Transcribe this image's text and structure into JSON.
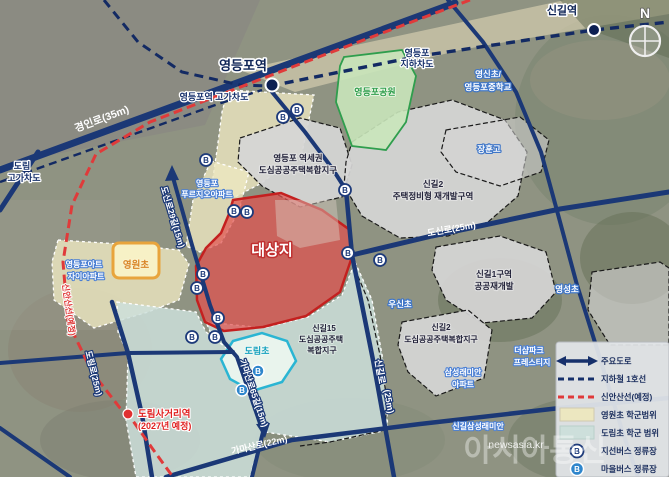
{
  "compass": "N",
  "target_label": "대상지",
  "park_label": "영등포공원",
  "bus_letter": "B",
  "stations": {
    "yeongdeungpo": "영등포역",
    "singil": "신길역",
    "dorim_name": "도림사거리역",
    "dorim_note": "(2027년 예정)"
  },
  "roads": {
    "gyeongin": "경인로(35m)",
    "ydp_overpass": "영등포역 고가차도",
    "ydp_underpass_1": "영등포",
    "ydp_underpass_2": "지하차도",
    "dorim_overpass_1": "도림",
    "dorim_overpass_2": "고가차도",
    "dosinro29": "도신로29길(15m)",
    "dosinro": "도신로(25m)",
    "singilro_1": "신길로",
    "singilro_2": "(25m)",
    "gamasan65": "가마산로65길(15m)",
    "gamasan": "가마산로(22m)",
    "dorimro": "도림로(25m)",
    "sinansan": "신안산선(예정)"
  },
  "zones": {
    "ydp_station": [
      "영등포 역세권",
      "도심공공주택복합지구"
    ],
    "singil2_north": [
      "신길2",
      "주택정비형 재개발구역"
    ],
    "singil1": [
      "신길1구역",
      "공공재개발"
    ],
    "singil15": [
      "신길15",
      "도심공공주택",
      "복합지구"
    ],
    "singil2_south": [
      "신길2",
      "도심공공주택복합지구"
    ]
  },
  "schools": {
    "yeongwon": "영원초",
    "dorim": "도림초",
    "woosin": "우신초",
    "janghoon": "장훈고",
    "yeongshin_1": "영신초/",
    "yeongshin_2": "영등포중학교",
    "yeongsung": "영성초"
  },
  "apartments": {
    "prugio": [
      "영등포",
      "푸르지오아파트"
    ],
    "artjai": [
      "영등포아트",
      "자이아파트"
    ],
    "samsung": [
      "삼성래미안",
      "아파트"
    ],
    "thesharp": [
      "더샵파크",
      "프레스티지"
    ],
    "singil_samsung": "신길삼성래미안"
  },
  "legend": {
    "items": [
      "주요도로",
      "지하철 1호선",
      "신안산선(예정)",
      "영원초 학군범위",
      "도림초 학군 범위",
      "지선버스 정류장",
      "마을버스 정류장"
    ]
  },
  "watermark": {
    "brand": "아시아통신",
    "url": "newsasia.kr"
  },
  "colors": {
    "road_navy": "#1b3876",
    "rail_navy": "#132a63",
    "sinansan_red": "#e03a3a",
    "target_red": "#c4201f",
    "school_yellow": "#f7f1c6",
    "district_blue": "#cddfdb",
    "park_green": "#c9e6ba",
    "village_bus_blue": "#2f86cc"
  }
}
